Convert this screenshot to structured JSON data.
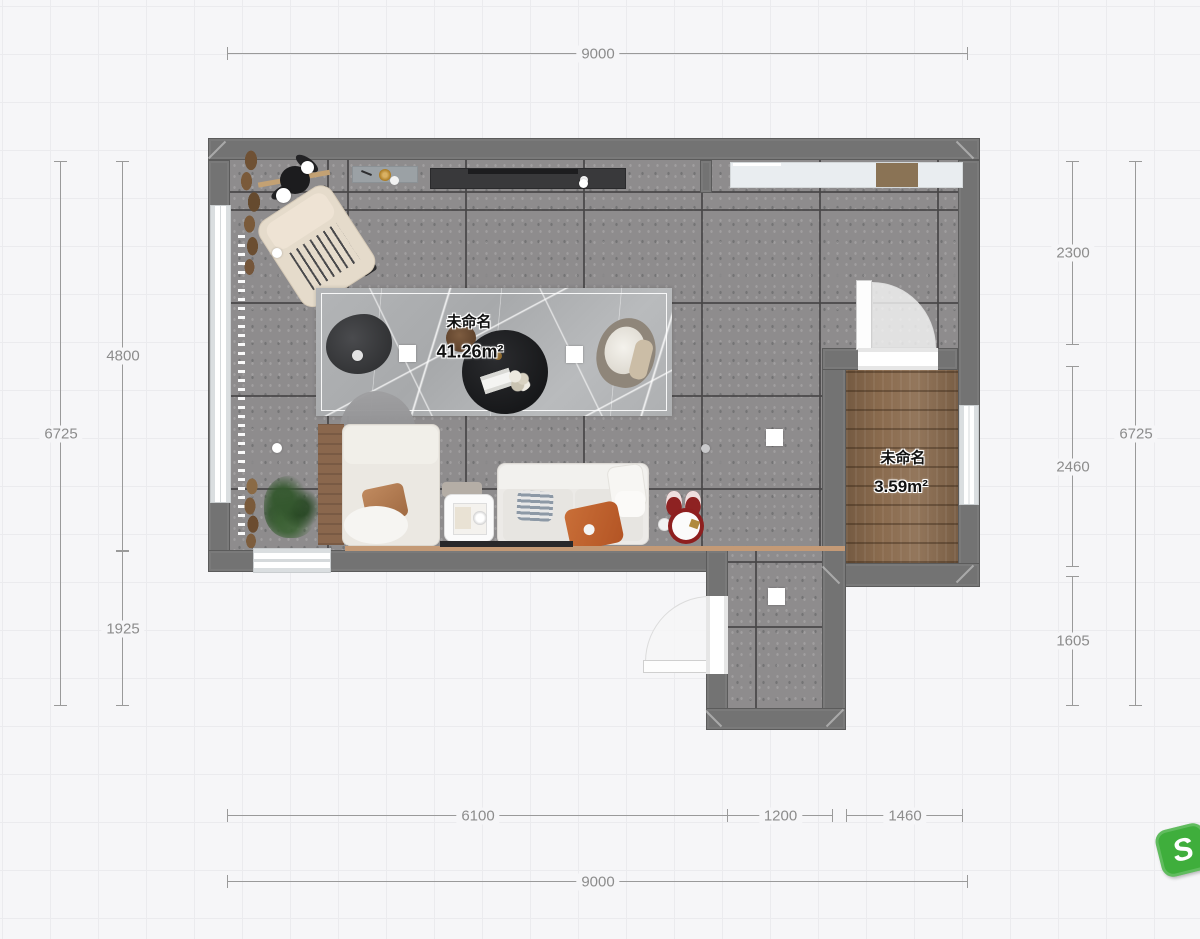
{
  "canvas": {
    "width": 1200,
    "height": 939
  },
  "rooms": {
    "living": {
      "name": "未命名",
      "area": "41.26m²"
    },
    "storage": {
      "name": "未命名",
      "area": "3.59m²"
    }
  },
  "dims": {
    "top": {
      "label": "9000"
    },
    "bottom_inner": [
      {
        "label": "6100"
      },
      {
        "label": "1200"
      },
      {
        "label": "1460"
      }
    ],
    "bottom_outer": {
      "label": "9000"
    },
    "left_inner": [
      {
        "label": "4800"
      },
      {
        "label": "1925"
      }
    ],
    "left_outer": {
      "label": "6725"
    },
    "right_inner": [
      {
        "label": "2300"
      },
      {
        "label": "2460"
      },
      {
        "label": "1605"
      }
    ],
    "right_outer": {
      "label": "6725"
    }
  },
  "watermark": {
    "letter": "S",
    "color": "#3fae3c"
  },
  "colors": {
    "wall": "#737373",
    "tile_floor": "#8e8c8d",
    "wood_floor": "#8a6b4e",
    "rug": "#b2b4b6",
    "accent_orange": "#c2602c",
    "watermark_green": "#3fae3c",
    "dimension_text": "#8c8c8c"
  }
}
